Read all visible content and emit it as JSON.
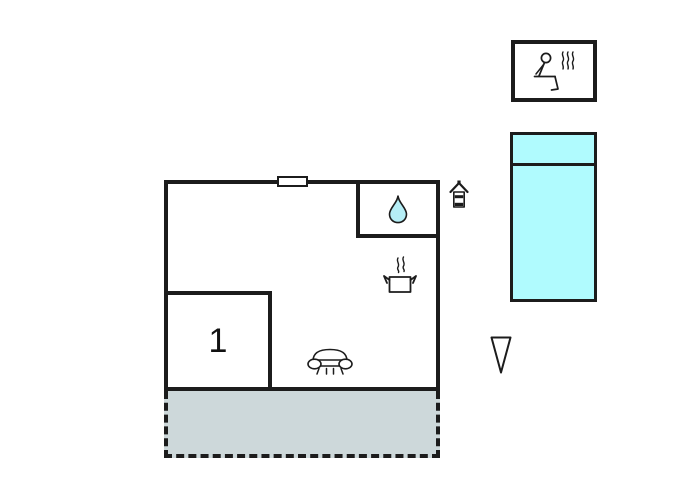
{
  "floorplan": {
    "room_label": "1"
  },
  "icons": {
    "sauna": "person-sitting-with-steam",
    "bathroom": "water-drop",
    "kitchen": "steaming-cooking-pot",
    "living_area": "sofa-side-view",
    "utility": "water-heater-house",
    "pointer": "downward-triangle",
    "window": "window-gap-marker"
  },
  "colors": {
    "wall": "#1c1c1c",
    "pool-fill": "#b0fbfe",
    "drop-fill": "#b5eef6",
    "terrace-fill": "#cdd8da",
    "canvas-bg": "#ffffff"
  }
}
